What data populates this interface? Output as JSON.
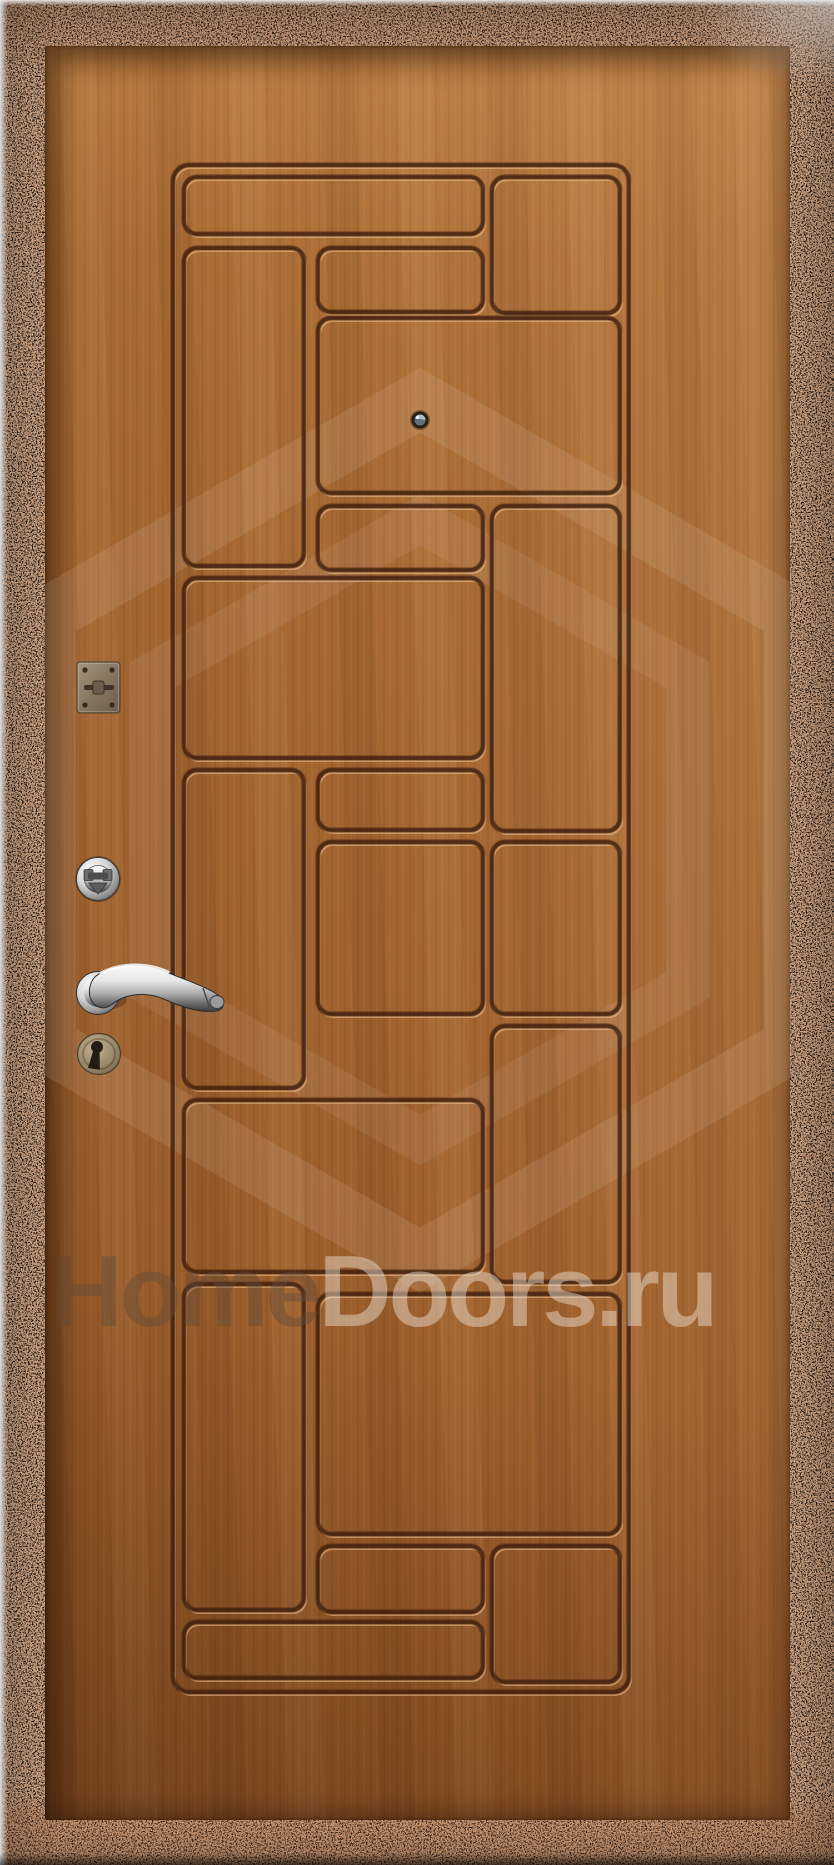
{
  "watermark": {
    "text_full": "HomeDoors.ru",
    "text_home": "Home",
    "text_doors": "Doors.ru"
  },
  "colors": {
    "wood_base": "#a2622e",
    "wood_light": "#bf8348",
    "wood_dark": "#7c4a1f",
    "groove_shadow": "#4a240c",
    "groove_highlight": "#e2b074",
    "frame_black": "#1b1511",
    "frame_copper": "#b26038",
    "chrome_hardware": "#d8d8d8",
    "keyhole_brass": "#9a8a6e"
  }
}
